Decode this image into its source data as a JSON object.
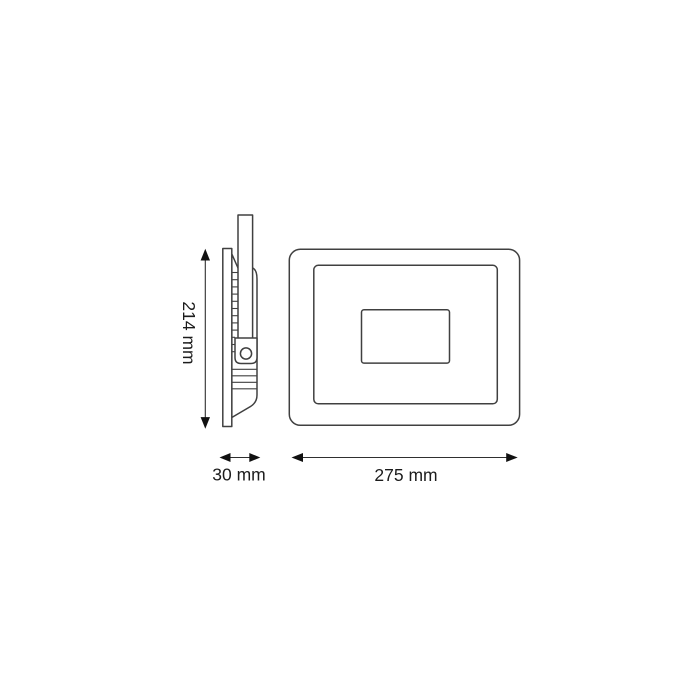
{
  "diagram": {
    "type": "technical-dimension-drawing",
    "views": {
      "side_view": "side profile with heatsink fins and mounting bracket",
      "front_view": "front face with inner frame and driver box"
    },
    "dimensions": {
      "height": {
        "label": "214 mm",
        "value": 214,
        "unit": "mm"
      },
      "depth": {
        "label": "30 mm",
        "value": 30,
        "unit": "mm"
      },
      "width": {
        "label": "275 mm",
        "value": 275,
        "unit": "mm"
      }
    },
    "colors": {
      "line": "#404040",
      "arrow": "#111111",
      "text": "#1c1c1c",
      "background": "#ffffff"
    }
  }
}
